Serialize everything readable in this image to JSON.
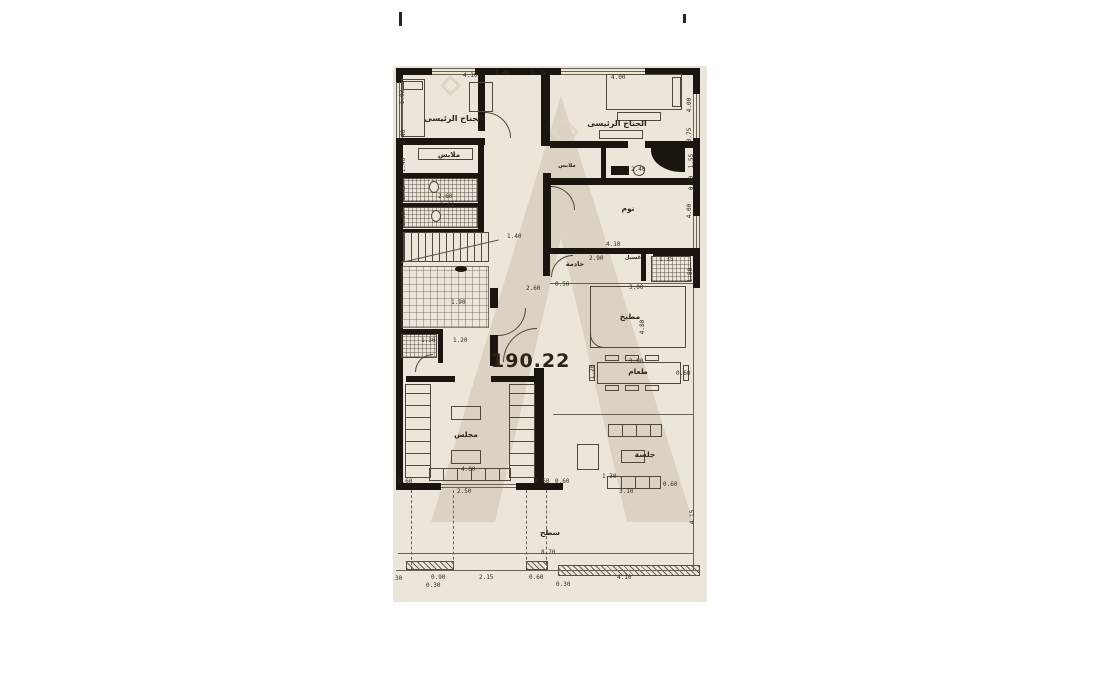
{
  "document": {
    "type": "architectural-floor-plan",
    "sheet_bg": "#ece5d9",
    "wall_color": "#1a150f",
    "watermark_color": "#d8cfc0",
    "area_value": "190.22"
  },
  "rooms": {
    "master_left": "الجناح الرئيسى",
    "master_right": "الجناح الرئيسى",
    "closet_left": "ملابس",
    "closet_right": "ملابس",
    "bedroom": "نوم",
    "maid": "خادمة",
    "laundry": "غسيل",
    "kitchen": "مطبخ",
    "dining": "طعام",
    "majlis": "مجلس",
    "sitting": "جلسة",
    "terrace": "سطح"
  },
  "dimensions": [
    {
      "t": "4.10",
      "x": 70,
      "y": 7,
      "r": 0
    },
    {
      "t": "1.40",
      "x": 102,
      "y": 5,
      "r": 0
    },
    {
      "t": "0.70",
      "x": 138,
      "y": 5,
      "r": 0
    },
    {
      "t": "4.00",
      "x": 218,
      "y": 9,
      "r": 0
    },
    {
      "t": "1.02",
      "x": 3,
      "y": 28,
      "r": -90
    },
    {
      "t": "1.40",
      "x": 4,
      "y": 68,
      "r": -90
    },
    {
      "t": "1.40",
      "x": 4,
      "y": 96,
      "r": -90
    },
    {
      "t": "1.45",
      "x": 4,
      "y": 124,
      "r": -90
    },
    {
      "t": "1.30",
      "x": 4,
      "y": 150,
      "r": -90
    },
    {
      "t": "4.00",
      "x": 290,
      "y": 36,
      "r": -90
    },
    {
      "t": "0.75",
      "x": 290,
      "y": 66,
      "r": -90
    },
    {
      "t": "1.55",
      "x": 292,
      "y": 92,
      "r": -90
    },
    {
      "t": "0.70",
      "x": 292,
      "y": 114,
      "r": -90
    },
    {
      "t": "4.00",
      "x": 290,
      "y": 142,
      "r": -90
    },
    {
      "t": "2.40",
      "x": 238,
      "y": 101,
      "r": 0
    },
    {
      "t": "2.60",
      "x": 45,
      "y": 128,
      "r": 0
    },
    {
      "t": "2.60",
      "x": 47,
      "y": 137,
      "r": 0
    },
    {
      "t": "1.90",
      "x": 58,
      "y": 234,
      "r": 0
    },
    {
      "t": "1.40",
      "x": 114,
      "y": 168,
      "r": 0
    },
    {
      "t": "4.10",
      "x": 213,
      "y": 176,
      "r": 0
    },
    {
      "t": "2.90",
      "x": 196,
      "y": 190,
      "r": 0
    },
    {
      "t": "1.35",
      "x": 266,
      "y": 191,
      "r": 0
    },
    {
      "t": "1.30",
      "x": 28,
      "y": 272,
      "r": 0
    },
    {
      "t": "1.20",
      "x": 60,
      "y": 272,
      "r": 0
    },
    {
      "t": "0.50",
      "x": 162,
      "y": 216,
      "r": 0
    },
    {
      "t": "2.60",
      "x": 133,
      "y": 220,
      "r": 0
    },
    {
      "t": "3.00",
      "x": 236,
      "y": 219,
      "r": 0
    },
    {
      "t": "4.80",
      "x": 243,
      "y": 258,
      "r": -90
    },
    {
      "t": "1.50",
      "x": 291,
      "y": 206,
      "r": -90
    },
    {
      "t": "3.00",
      "x": 236,
      "y": 293,
      "r": 0
    },
    {
      "t": "0.60",
      "x": 283,
      "y": 305,
      "r": 0
    },
    {
      "t": "1.20",
      "x": 193,
      "y": 303,
      "r": -90
    },
    {
      "t": "1.30",
      "x": 209,
      "y": 408,
      "r": 0
    },
    {
      "t": "4.00",
      "x": 68,
      "y": 401,
      "r": 0
    },
    {
      "t": "2.50",
      "x": 64,
      "y": 423,
      "r": 0
    },
    {
      "t": "0.60",
      "x": 5,
      "y": 413,
      "r": 0
    },
    {
      "t": "0.60",
      "x": 142,
      "y": 413,
      "r": 0
    },
    {
      "t": "0.60",
      "x": 162,
      "y": 413,
      "r": 0
    },
    {
      "t": "3.10",
      "x": 226,
      "y": 423,
      "r": 0
    },
    {
      "t": "0.60",
      "x": 270,
      "y": 416,
      "r": 0
    },
    {
      "t": "4.15",
      "x": 293,
      "y": 448,
      "r": -90
    },
    {
      "t": "8.70",
      "x": 148,
      "y": 484,
      "r": 0
    },
    {
      "t": "30",
      "x": 2,
      "y": 510,
      "r": 0
    },
    {
      "t": "0.90",
      "x": 38,
      "y": 509,
      "r": 0
    },
    {
      "t": "0.30",
      "x": 33,
      "y": 517,
      "r": 0
    },
    {
      "t": "2.15",
      "x": 86,
      "y": 509,
      "r": 0
    },
    {
      "t": "0.60",
      "x": 136,
      "y": 509,
      "r": 0
    },
    {
      "t": "0.30",
      "x": 163,
      "y": 516,
      "r": 0
    },
    {
      "t": "4.10",
      "x": 224,
      "y": 509,
      "r": 0
    }
  ]
}
